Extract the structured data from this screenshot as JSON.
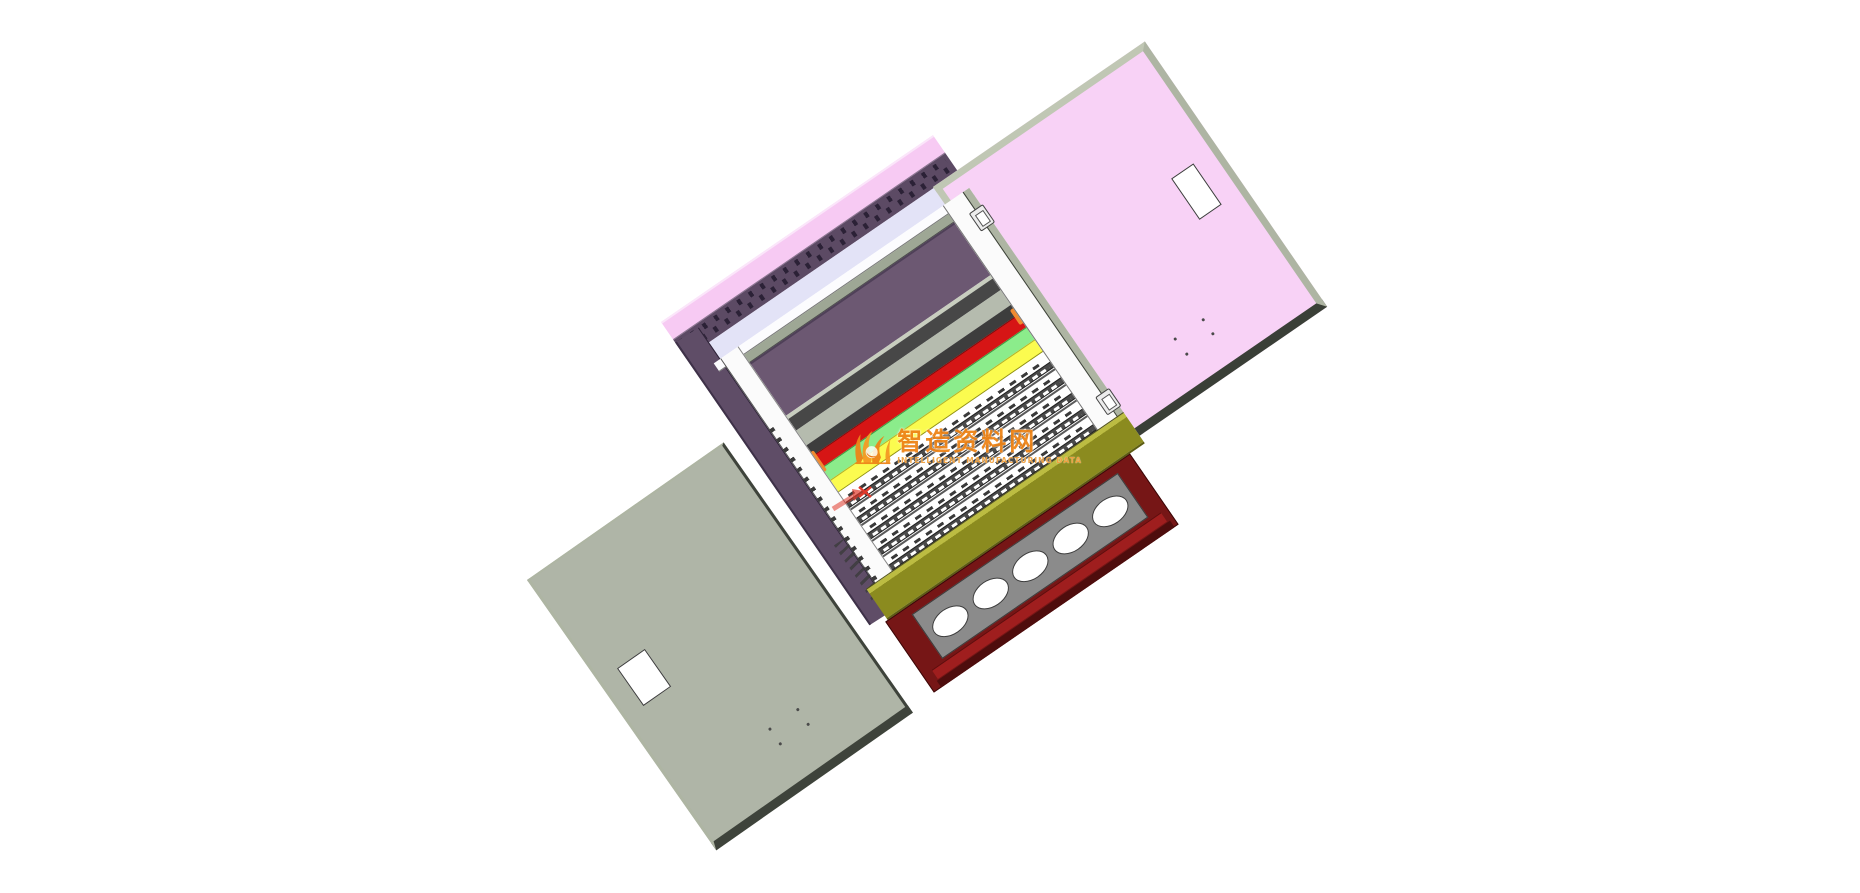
{
  "scene": {
    "description": "3D CAD assembly view of an electrical distribution cabinet with both doors open",
    "view_background": "#ffffff"
  },
  "watermark": {
    "title": "智造资料网",
    "tagline": "INTELLIGENT MANUFACTURING DATA",
    "logo": "flame-logo-icon",
    "color": "#EE8418"
  },
  "cursor": {
    "type": "selection-arrow-with-x",
    "color": "#E0392B"
  },
  "parts": {
    "pink_door": {
      "name": "front door (open, pink)",
      "cutout_window": 1,
      "mounting_dots": 4
    },
    "gray_door": {
      "name": "rear door (open, sage gray)",
      "cutout_window": 1,
      "mounting_dots": 4
    },
    "back_panel_strips": [
      "pink back edge",
      "slotted purple strip",
      "lavender strip"
    ],
    "left_side_wall": "purple side wall",
    "mounting_panel": "purple equipment panel",
    "busbars": [
      "red phase bar",
      "green phase bar",
      "yellow phase bar"
    ],
    "busbar_end_clips": {
      "orange_clips": 3,
      "brown_clip": 1
    },
    "terminal_field": {
      "rail_count": 5,
      "rail_rows": [
        248,
        267,
        286,
        305,
        324
      ]
    },
    "hinge_nubs": 2,
    "olive_bottom_rail": "dark yellow bottom rail",
    "bottom_gland_section": {
      "frame": "maroon frame",
      "plate": "gray gland plate",
      "hole_count": 5
    }
  },
  "colors": {
    "bg": "#ffffff",
    "door_pink_face": "#F8D2F6",
    "door_edge_light": "#C0C7B4",
    "door_edge_mid": "#AEB5A3",
    "door_edge_dark": "#3A3F37",
    "door_gray_face": "#AFB5A7",
    "door_gray_edge": "#3E433B",
    "back_pink": "#F7CAF3",
    "slot_strip": "#5C4A64",
    "slot_hole": "#2B2136",
    "lavender": "#E3E3F7",
    "left_wall": "#5F4D67",
    "bevel": "#9EA795",
    "panel_purple": "#6C5872",
    "panel_edge": "#4F4058",
    "pale_line": "#C8CEBF",
    "dark_band": "#474747",
    "pale_band": "#B5BBAE",
    "dark_band2": "#3D3D3D",
    "bar_red": "#D61515",
    "bar_green": "#8BEC8B",
    "bar_yellow": "#FBFB4F",
    "clip_orange": "#F08A30",
    "clip_brown": "#7A4A28",
    "rail_dark": "#4A4A4A",
    "rail_dash": "#ffffff",
    "tick_dark": "#3A3A3A",
    "olive": "#8B8B1F",
    "olive_light": "#BCBC42",
    "maroon": "#761616",
    "maroon_dark": "#4E0D0D",
    "red_stripe": "#9F1E1E",
    "gland_gray": "#8B8B8B",
    "watermark_orange": "#EE8418"
  }
}
